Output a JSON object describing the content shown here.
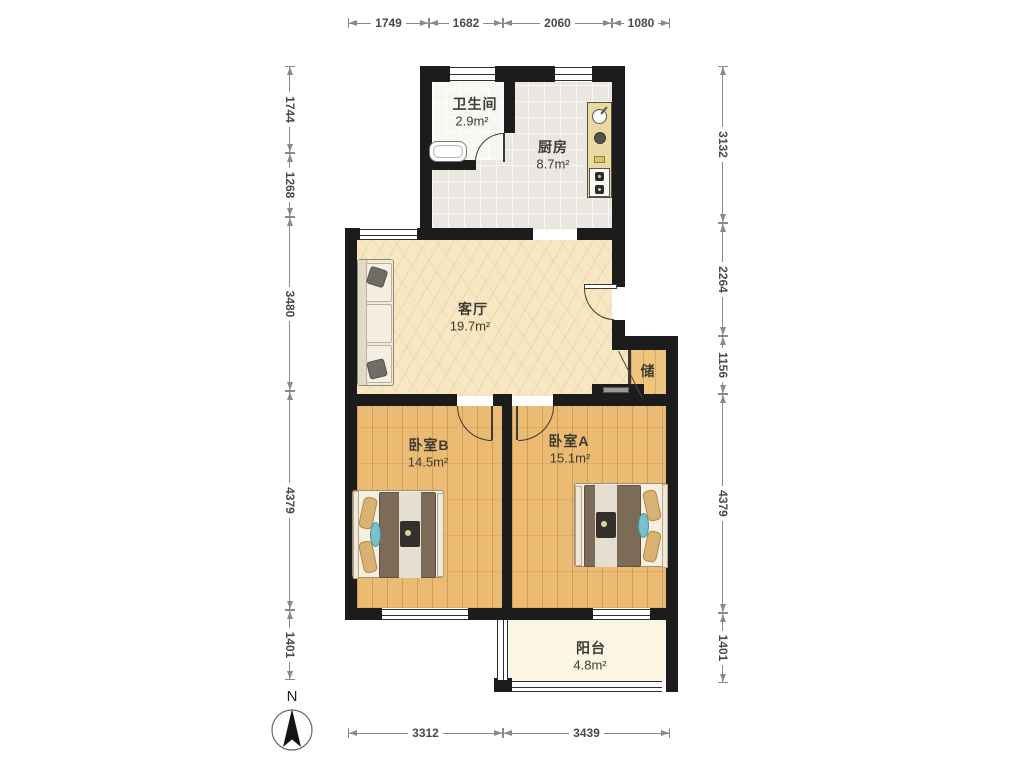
{
  "plan": {
    "compass_label": "N",
    "rooms": {
      "bathroom": {
        "name": "卫生间",
        "area": "2.9m²"
      },
      "kitchen": {
        "name": "厨房",
        "area": "8.7m²"
      },
      "living": {
        "name": "客厅",
        "area": "19.7m²"
      },
      "storage": {
        "name": "储"
      },
      "bedroom_b": {
        "name": "卧室B",
        "area": "14.5m²"
      },
      "bedroom_a": {
        "name": "卧室A",
        "area": "15.1m²"
      },
      "balcony": {
        "name": "阳台",
        "area": "4.8m²"
      }
    },
    "dimensions": {
      "top": [
        "1749",
        "1682",
        "2060",
        "1080"
      ],
      "bottom": [
        "3312",
        "3439"
      ],
      "left": [
        "1744",
        "1268",
        "3480",
        "4379",
        "1401"
      ],
      "right": [
        "3132",
        "2264",
        "1156",
        "4379",
        "1401"
      ]
    },
    "colors": {
      "wall": "#1c1c1c",
      "living_floor": "#f7e7c2",
      "bedroom_floor": "#ecbb73",
      "kitchen_floor": "#e9e7e0",
      "bath_floor": "#f6f6f3",
      "balcony_floor": "#fbf6e1",
      "storage_floor": "#efc57e",
      "counter": "#ead9a2",
      "dim_line": "#8a8a8a",
      "text": "#3c3b33"
    }
  }
}
